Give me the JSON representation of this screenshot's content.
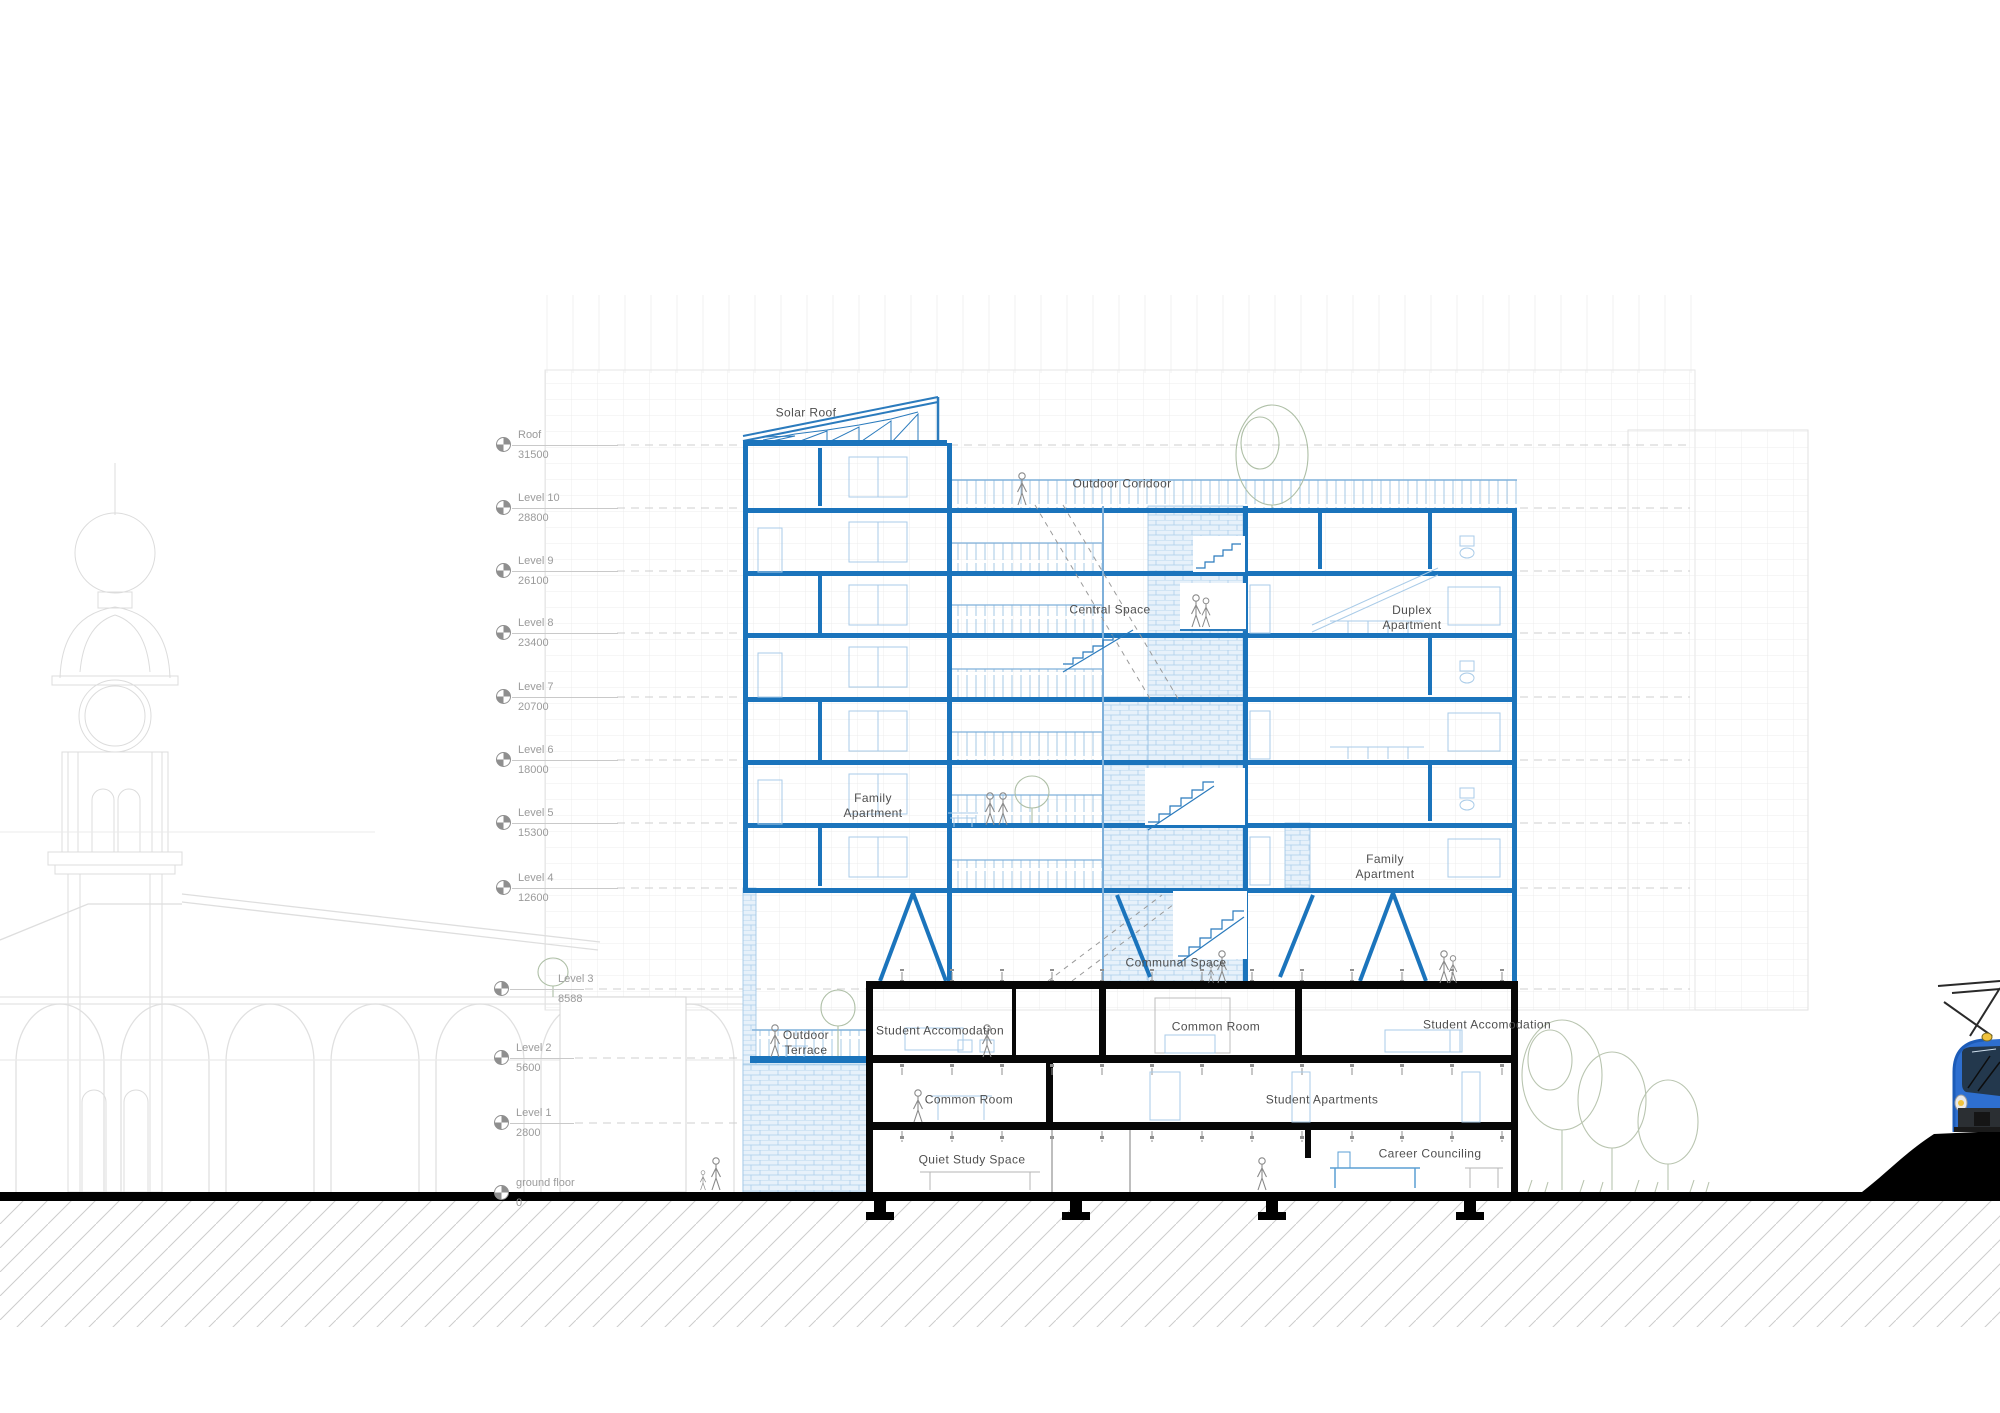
{
  "drawing": {
    "type": "architectural-section",
    "room_labels": {
      "solar_roof": "Solar Roof",
      "outdoor_corridor": "Outdoor Coridoor",
      "central_space": "Central Space",
      "duplex_apartment": "Duplex Apartment",
      "family_apartment_upper": "Family Apartment",
      "family_apartment_right": "Family Apartment",
      "communal_space": "Communal Space",
      "student_accomodation_left": "Student Accomodation",
      "common_room_upper": "Common Room",
      "student_accomodation_right": "Student Accomodation",
      "outdoor_terrace": "Outdoor Terrace",
      "common_room_lower": "Common Room",
      "student_apartments": "Student Apartments",
      "quiet_study_space": "Quiet Study Space",
      "career_counciling": "Career Counciling"
    },
    "levels": [
      {
        "name": "Roof",
        "elevation": "31500"
      },
      {
        "name": "Level 10",
        "elevation": "28800"
      },
      {
        "name": "Level 9",
        "elevation": "26100"
      },
      {
        "name": "Level 8",
        "elevation": "23400"
      },
      {
        "name": "Level 7",
        "elevation": "20700"
      },
      {
        "name": "Level 6",
        "elevation": "18000"
      },
      {
        "name": "Level 5",
        "elevation": "15300"
      },
      {
        "name": "Level 4",
        "elevation": "12600"
      },
      {
        "name": "Level 3",
        "elevation": "8588"
      },
      {
        "name": "Level 2",
        "elevation": "5600"
      },
      {
        "name": "Level 1",
        "elevation": "2800"
      },
      {
        "name": "ground floor",
        "elevation": "0"
      }
    ],
    "colors": {
      "structure_blue": "#1b74bc",
      "light_blue": "#a9cbe8",
      "hatch_fill": "#e7f1fa",
      "podium_black": "#070707",
      "tram_blue": "#2e6fd0",
      "headlight_yellow": "#f0c23c",
      "background_gray": "#ececec",
      "tree_green": "#b9c5b0"
    }
  }
}
